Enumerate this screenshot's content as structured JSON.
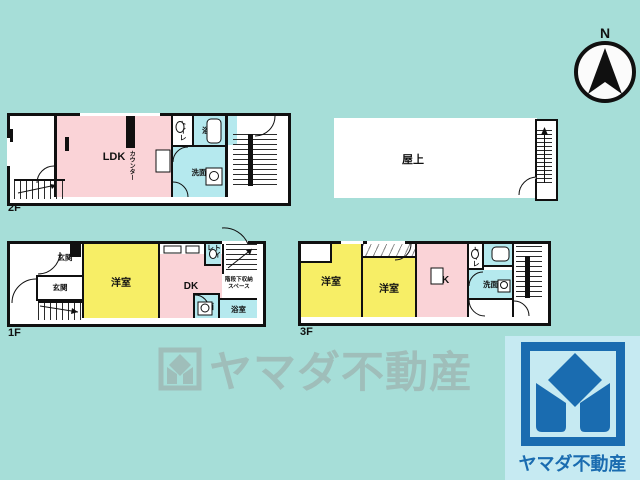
{
  "colors": {
    "background": "#a6ded8",
    "room_pink": "#fad3d7",
    "room_yellow": "#f7ee66",
    "room_cyan": "#b5e9ee",
    "wall_black": "#101010",
    "watermark_gray": "#9fbeba",
    "brand_blue": "#1a6cb0",
    "brand_panel_bg": "#c6eaf2"
  },
  "compass": {
    "label": "N"
  },
  "floor2": {
    "label": "2F",
    "ldk": "LDK",
    "counter": "カウンター",
    "toilet": "トイレ",
    "bath": "浴室",
    "wash": "洗面"
  },
  "roof": {
    "label": "屋上"
  },
  "floor1": {
    "label": "1F",
    "entrance_upper": "玄関",
    "entrance_lower": "玄関",
    "western_room": "洋室",
    "dk": "DK",
    "toilet": "トイレ",
    "wash": "洗面",
    "bath": "浴室",
    "under_stair_storage": "階段下収納スペース"
  },
  "floor3": {
    "label": "3F",
    "western_room_left": "洋室",
    "western_room_right": "洋室",
    "dk": "DK",
    "toilet": "トイレ",
    "bath": "浴室",
    "wash": "洗面"
  },
  "watermark": {
    "text": "ヤマダ不動産"
  },
  "brand": {
    "name": "ヤマダ不動産"
  }
}
